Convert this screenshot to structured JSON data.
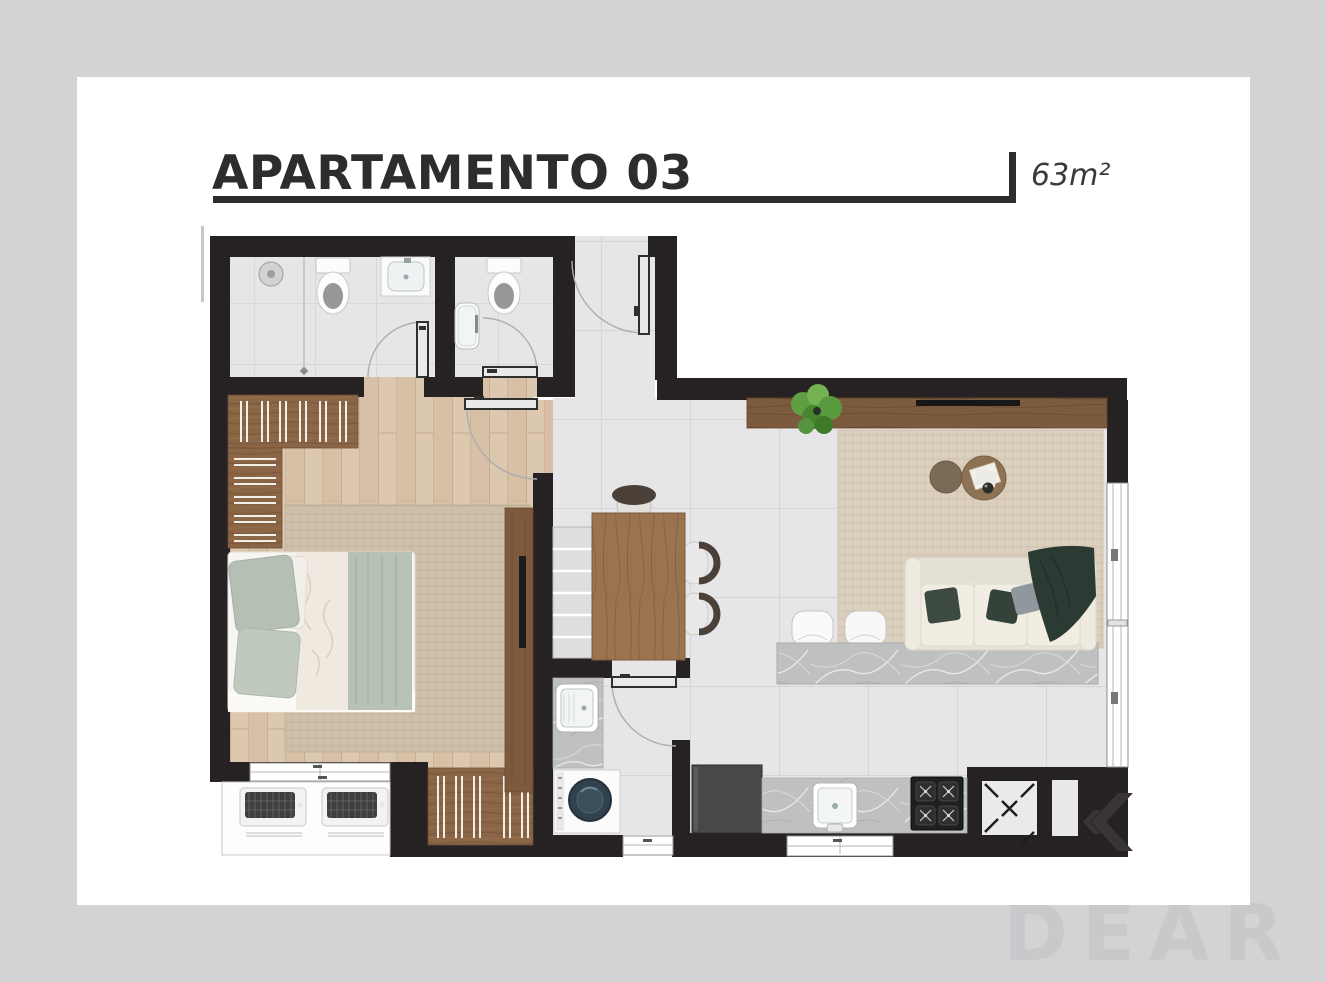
{
  "header": {
    "title": "APARTAMENTO 03",
    "area": "63m²"
  },
  "watermark": {
    "brand": "IDEAR"
  },
  "palette": {
    "bg": "#d3d3d5",
    "card": "#ffffff",
    "wall": "#262223",
    "title": "#2f2c2d",
    "area-text": "#3a3a3a",
    "tile": "#e6e6e8",
    "tile-line": "#d5d5d8",
    "wood-floor": "#dcc7af",
    "closet-wood": "#8a6647",
    "rug-bedroom": "#cec0ab",
    "rug-living": "#dbcfbd",
    "sofa": "#e8e3d8",
    "pillow-green": "#3c4a42",
    "throw-green": "#2b3a32",
    "sage": "#b7c1b5",
    "marble": "#bec0c2",
    "table-wood": "#9b744f",
    "console-wood": "#7b5a3e",
    "plant-green": "#5a9b3d",
    "appliance-dark": "#48484a",
    "watermark-text": "#c9c9cc"
  }
}
